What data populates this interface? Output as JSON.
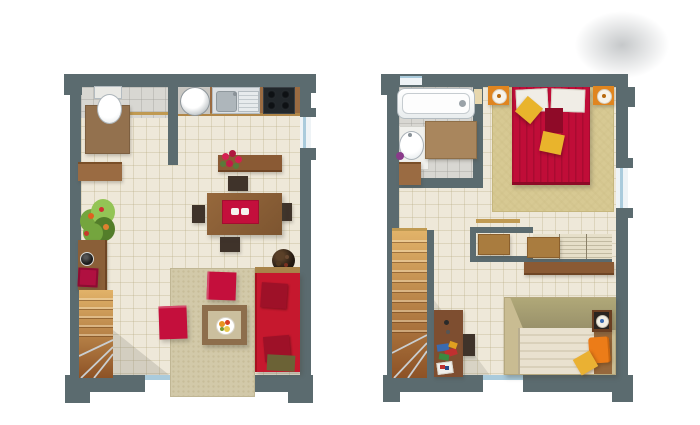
{
  "image": {
    "type": "architectural-floor-plan-pair",
    "description": "Top-down rendered floor plans of a two-level apartment, lower level on the left and upper level on the right, on a white background with a soft grey smudge at the top right",
    "width_px": 700,
    "height_px": 425,
    "background": "#ffffff"
  },
  "colors": {
    "wall": "#5b6b6f",
    "floorBeige": "#eee8d9",
    "floorLine": "#b9ad8455",
    "floorGray": "#d8d7d2",
    "grayLine": "#9fa09a66",
    "counter": "#9a6b42",
    "woodShelf": "#8a5a34",
    "woodDark": "#7a4a2a",
    "deskWood": "#7e4e30",
    "tableWood": "#8a5f38",
    "chairDark": "#3f332a",
    "red": "#c40f3c",
    "redDark": "#a30d30",
    "sofa": "#c6182e",
    "sofaCushion": "#9e1128",
    "oliveCushion": "#6b6236",
    "goldTrim": "#a9844a",
    "bedRed": "#c00d38",
    "bedStripe": "#a90b31",
    "gold": "#e9b42c",
    "orange": "#ec7c18",
    "nightOrange": "#e0851f",
    "rugGold": "#d7c993",
    "rugBeige": "#d2c9a9",
    "khaki": "#c9bc92",
    "olive": "#a79e6f",
    "cream": "#e9e1cf",
    "creamStripe": "#d9d0ba",
    "matBrown": "#a9865d",
    "wcMat": "#93714e",
    "tan": "#c09a52",
    "glass": "#aacbdc",
    "glassBg": "#eef3f6",
    "white": "#f7f7f5",
    "steel": "#dde1e4",
    "steelDark": "#aeb6bb",
    "cooktop": "#22272b",
    "stairTop": "#e2b369",
    "stairBottom": "#8d5226",
    "plantGreen": "#74a53e",
    "plantDark": "#537d2a",
    "plantLight": "#93c455",
    "stoolRed": "#b01040",
    "purple": "#8a3a8a",
    "darkPlant": "#241a12",
    "doorBeige": "#e7d7ad",
    "boxBrown": "#a97c3f",
    "wardrobe": "#e6dfc9",
    "paper": "#f0efea"
  },
  "floors": [
    {
      "name": "lower-floor",
      "rooms": [
        "wc",
        "kitchen",
        "dining-area",
        "living-area",
        "stair-corner"
      ],
      "items": [
        "toilet",
        "wc-mat",
        "washing-machine",
        "kitchen-sink",
        "cooktop",
        "kitchen-counter",
        "flower-shelf",
        "red-flowers",
        "wall-cabinet",
        "green-plant",
        "console-desk",
        "red-stool",
        "staircase",
        "dining-table",
        "table-runner",
        "plates",
        "four-chairs",
        "dark-vase-plant",
        "area-rug",
        "two-red-floor-cushions",
        "coffee-table",
        "fruit-bowl",
        "red-sofa",
        "sofa-back-shelf",
        "right-window",
        "terrace-door"
      ]
    },
    {
      "name": "upper-floor",
      "rooms": [
        "bathroom",
        "master-bedroom",
        "dressing-area",
        "second-bedroom",
        "stair-hall"
      ],
      "items": [
        "bathtub",
        "wash-basin",
        "soap-dish",
        "bath-mat",
        "bath-cabinet",
        "bathroom-door",
        "double-bed",
        "white-pillows",
        "yellow-cushions",
        "red-throw",
        "nightstand-left",
        "nightstand-right",
        "gold-rug",
        "wardrobe-shelves",
        "storage-boxes",
        "wall-shelf",
        "staircase",
        "stair-wall",
        "desk",
        "desk-chair",
        "books-and-papers",
        "single-bed",
        "olive-headboard",
        "cream-duvet",
        "orange-pillow",
        "yellow-cushion",
        "nightstand",
        "right-window",
        "bottom-door",
        "top-window"
      ]
    }
  ]
}
